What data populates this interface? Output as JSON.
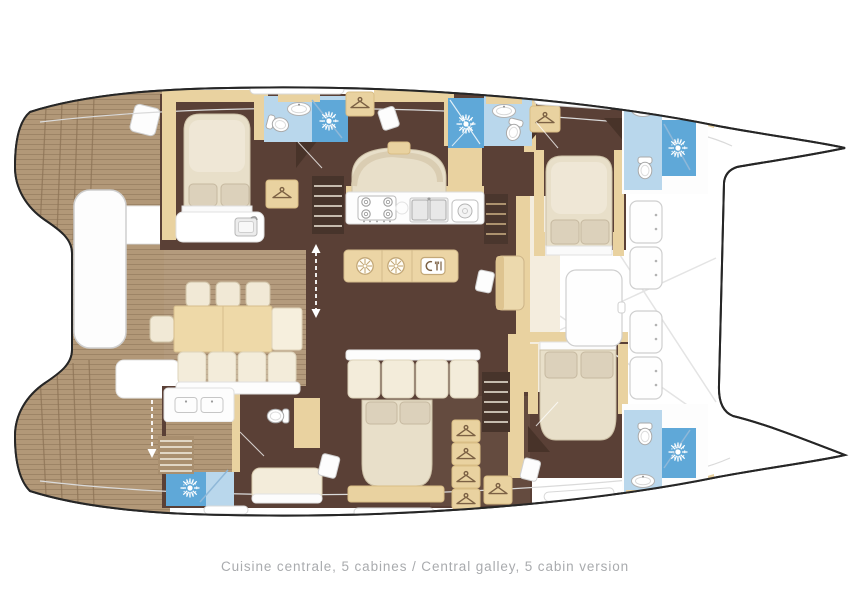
{
  "caption": {
    "text": "Cuisine centrale, 5 cabines / Central galley, 5 cabin version",
    "fr": "Cuisine centrale, 5 cabines",
    "en": "Central galley, 5 cabin version"
  },
  "palette": {
    "outline": "#262626",
    "deck_wood": "#b29878",
    "salon_wood": "#b49b7d",
    "floor_dark": "#5a4036",
    "floor_mid": "#6d5347",
    "cabinet_tan": "#e9d2a0",
    "cabinet_tan_deep": "#d9bd85",
    "furniture_cream": "#f3ecda",
    "bed_cream": "#e8dfc9",
    "linen": "#dcd1bb",
    "counter_white": "#fdfdfd",
    "tile_light": "#b9d7ec",
    "tile_shower": "#5fa8d8",
    "glass_blue": "#8fb8d8",
    "border_gray": "#cfcfcf",
    "caption_gray": "#a9abae"
  },
  "icons": [
    "shower-rosette-icon",
    "coat-hanger-icon",
    "toilet-icon",
    "washbasin-icon",
    "vanity-sink-icon",
    "faucet-sink-icon",
    "stove-burner-icon",
    "double-sink-icon",
    "fridge-icon",
    "cutlery-icon",
    "deck-locker-icon",
    "direction-arrow-icon"
  ]
}
